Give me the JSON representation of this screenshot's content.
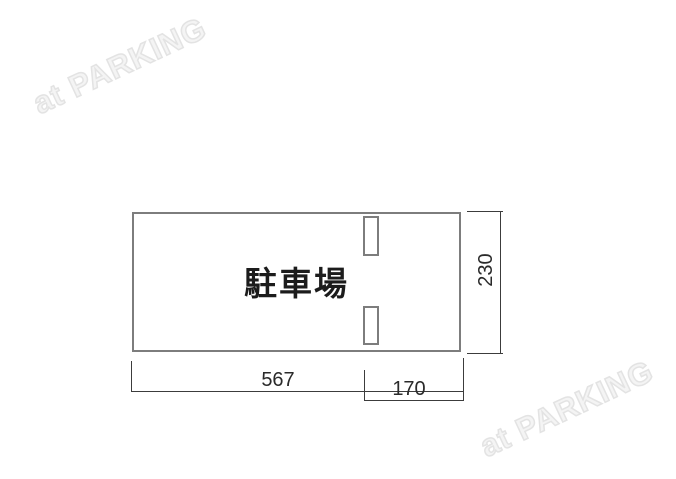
{
  "watermark": {
    "text": "at PARKING",
    "color": "#e3e3e3"
  },
  "diagram": {
    "area_label": "駐車場",
    "dimensions": {
      "width_label": "567",
      "entrance_label": "170",
      "depth_label": "230"
    },
    "colors": {
      "outline": "#7d7d7d",
      "dimension_line": "#3c3c3c",
      "label_text": "#1c1c1c",
      "background": "#ffffff"
    }
  }
}
